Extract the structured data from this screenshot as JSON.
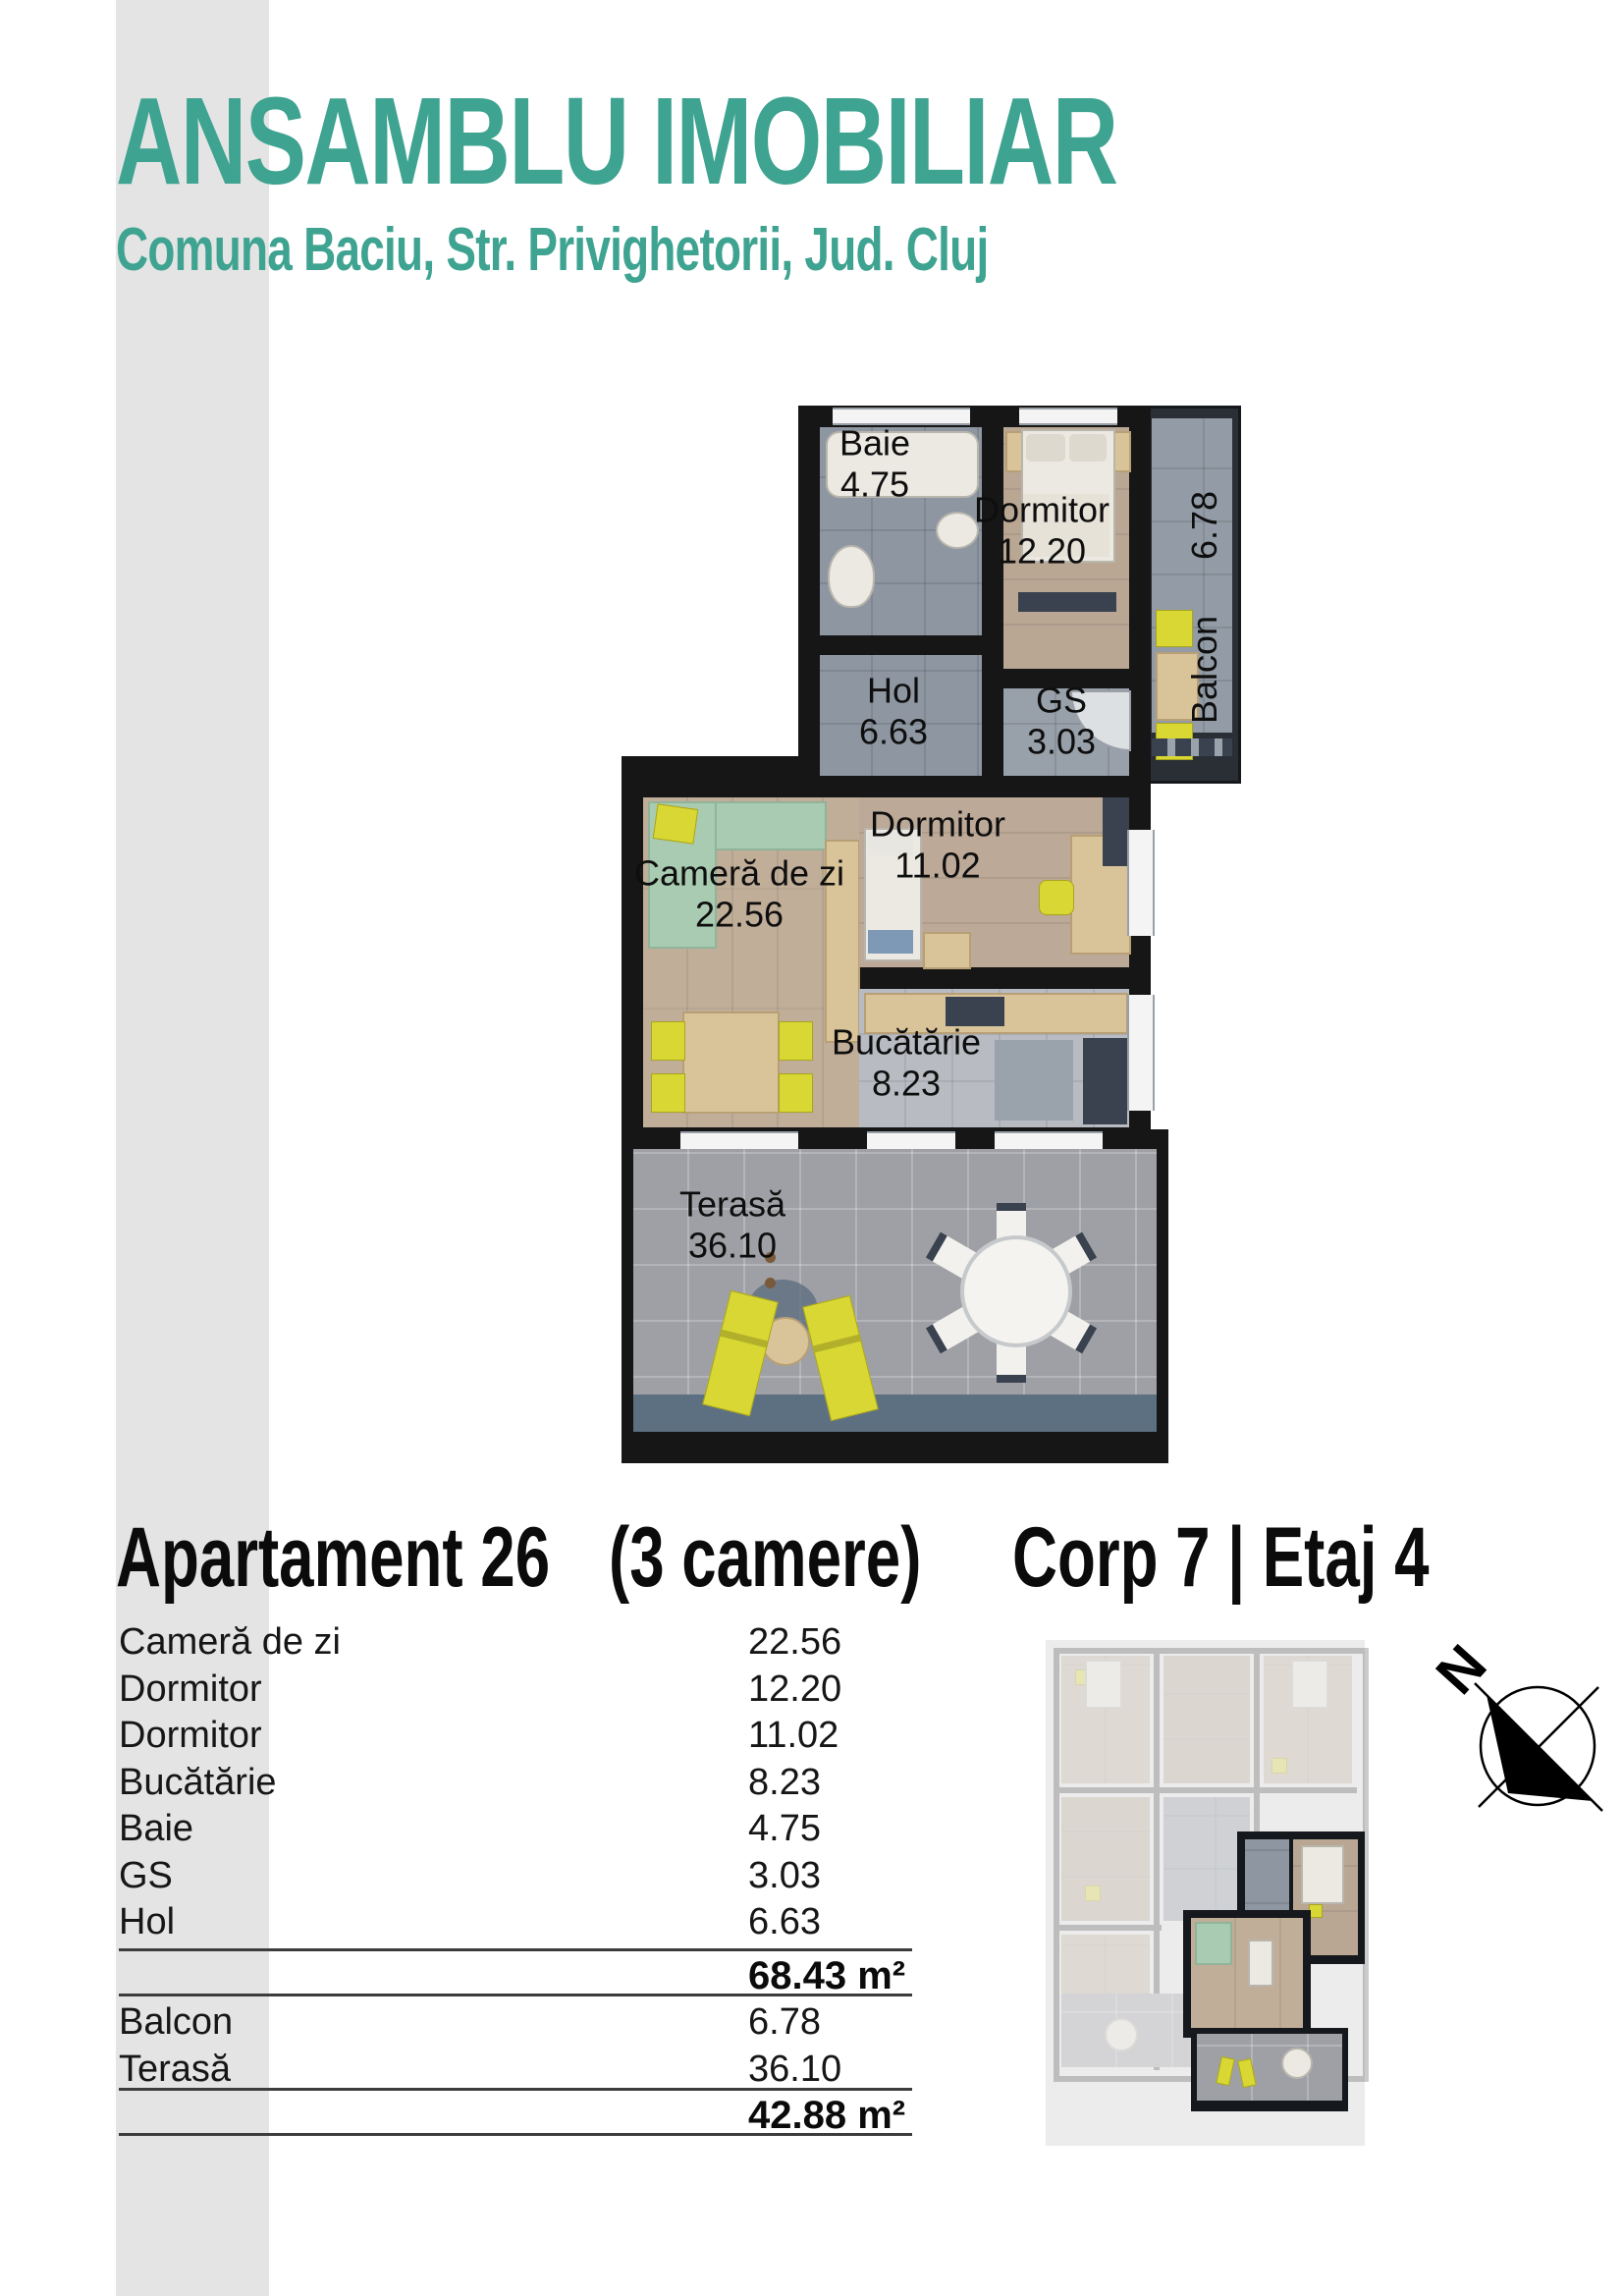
{
  "header": {
    "title": "ANSAMBLU IMOBILIAR",
    "subtitle": "Comuna Baciu, Str. Privighetorii, Jud. Cluj",
    "accent_color": "#3ea390"
  },
  "floorplan": {
    "labels": {
      "baie": {
        "name": "Baie",
        "area": "4.75"
      },
      "dormitor1": {
        "name": "Dormitor",
        "area": "12.20"
      },
      "balcon": {
        "name": "Balcon",
        "area": "6.78"
      },
      "hol": {
        "name": "Hol",
        "area": "6.63"
      },
      "gs": {
        "name": "GS",
        "area": "3.03"
      },
      "camera": {
        "name": "Cameră de zi",
        "area": "22.56"
      },
      "dormitor2": {
        "name": "Dormitor",
        "area": "11.02"
      },
      "bucatarie": {
        "name": "Bucătărie",
        "area": "8.23"
      },
      "terasa": {
        "name": "Terasă",
        "area": "36.10"
      }
    }
  },
  "apartment": {
    "name": "Apartament 26",
    "rooms_count": "(3 camere)",
    "location": "Corp  7  |  Etaj 4"
  },
  "table": {
    "rows": [
      {
        "label": "Cameră de zi",
        "value": "22.56"
      },
      {
        "label": "Dormitor",
        "value": "12.20"
      },
      {
        "label": "Dormitor",
        "value": "11.02"
      },
      {
        "label": "Bucătărie",
        "value": "8.23"
      },
      {
        "label": "Baie",
        "value": "4.75"
      },
      {
        "label": "GS",
        "value": "3.03"
      },
      {
        "label": "Hol",
        "value": "6.63"
      }
    ],
    "interior_total": "68.43 m²",
    "outdoor_rows": [
      {
        "label": "Balcon",
        "value": "6.78"
      },
      {
        "label": "Terasă",
        "value": "36.10"
      }
    ],
    "outdoor_total": "42.88 m²"
  },
  "compass": {
    "north": "N"
  }
}
